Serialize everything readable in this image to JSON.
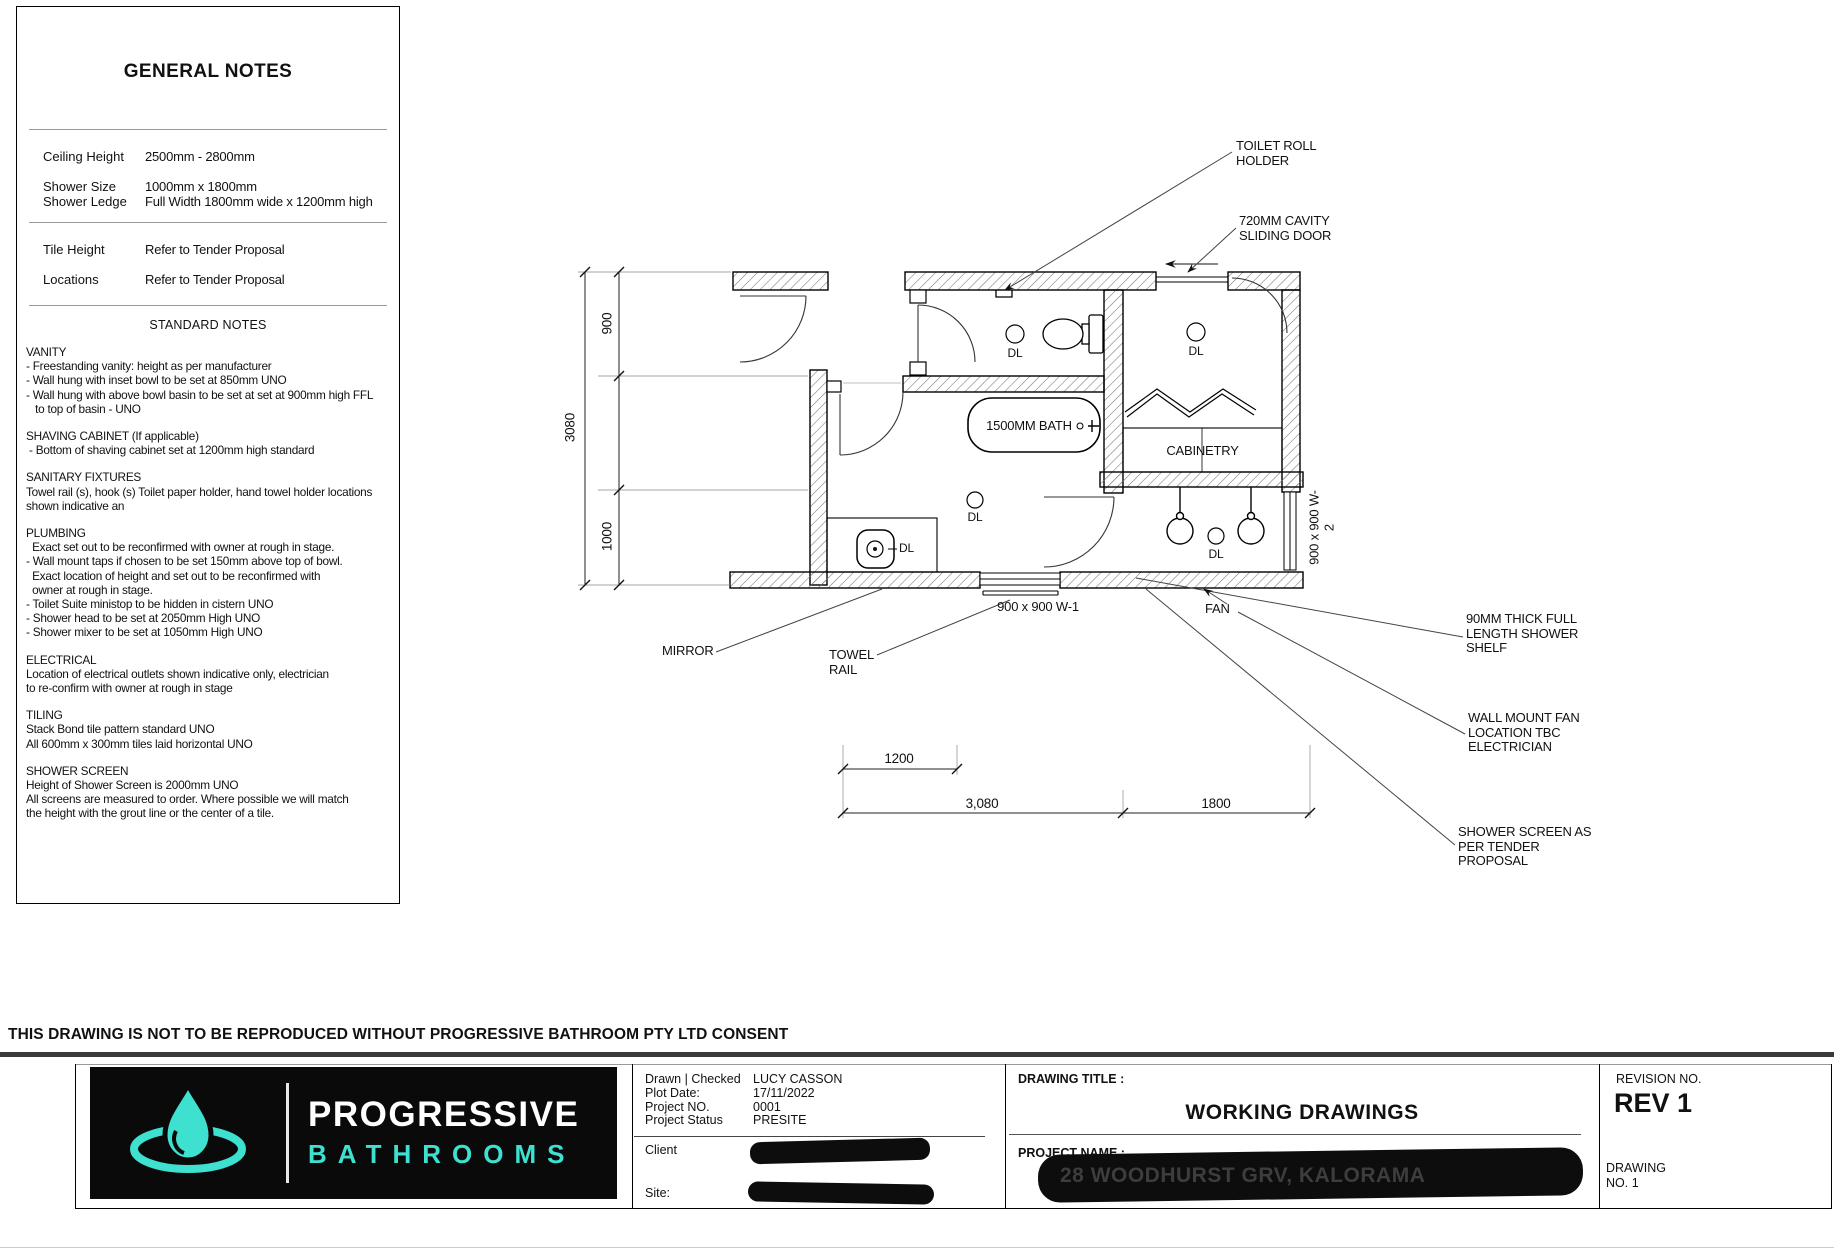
{
  "notes_panel": {
    "title": "GENERAL NOTES",
    "specs_a": [
      {
        "labels": [
          "Ceiling Height"
        ],
        "values": [
          "2500mm - 2800mm"
        ]
      },
      {
        "labels": [
          "Shower Size",
          "Shower Ledge"
        ],
        "values": [
          "1000mm x 1800mm",
          "Full Width 1800mm wide x 1200mm high"
        ]
      }
    ],
    "specs_b": [
      {
        "labels": [
          "Tile Height"
        ],
        "values": [
          "Refer to Tender Proposal"
        ]
      },
      {
        "labels": [
          "Locations"
        ],
        "values": [
          "Refer to Tender Proposal"
        ]
      }
    ],
    "standard_notes_title": "STANDARD NOTES",
    "sections": [
      {
        "heading": "VANITY",
        "lines": [
          "- Freestanding vanity: height as per manufacturer",
          "- Wall hung with inset bowl to be set at 850mm UNO",
          "- Wall hung with above bowl basin to be set at set at 900mm high FFL",
          "   to top of basin - UNO"
        ]
      },
      {
        "heading": "SHAVING CABINET (If applicable)",
        "lines": [
          " - Bottom of shaving cabinet set at 1200mm high standard"
        ]
      },
      {
        "heading": "SANITARY FIXTURES",
        "lines": [
          "Towel rail (s), hook (s) Toilet paper holder, hand towel holder locations",
          "shown indicative an"
        ]
      },
      {
        "heading": "PLUMBING",
        "lines": [
          "  Exact set out to be reconfirmed with owner at rough in stage.",
          "- Wall mount taps if chosen to be set 150mm above top of bowl.",
          "  Exact location of height and set out to be reconfirmed with",
          "  owner at rough in stage.",
          "- Toilet Suite ministop to be hidden in cistern UNO",
          "- Shower head to be set at 2050mm High UNO",
          "- Shower mixer to be set at 1050mm High UNO"
        ]
      },
      {
        "heading": "ELECTRICAL",
        "lines": [
          "Location of electrical outlets shown indicative only, electrician",
          "to re-confirm with owner at rough in stage"
        ]
      },
      {
        "heading": "TILING",
        "lines": [
          "Stack Bond tile pattern standard UNO",
          "All 600mm x 300mm tiles laid horizontal UNO"
        ]
      },
      {
        "heading": "SHOWER SCREEN",
        "lines": [
          "Height of Shower Screen is 2000mm UNO",
          "All screens are measured to order. Where possible we will match",
          "the height with the grout line or the center of a tile."
        ]
      }
    ]
  },
  "plan": {
    "labels": {
      "toilet_roll_holder": "TOILET ROLL HOLDER",
      "sliding_door": "720MM CAVITY SLIDING DOOR",
      "mirror": "MIRROR",
      "towel_rail": "TOWEL RAIL",
      "shower_shelf": "90MM THICK FULL LENGTH SHOWER SHELF",
      "wall_fan": "WALL MOUNT FAN LOCATION TBC ELECTRICIAN",
      "shower_screen": "SHOWER SCREEN AS PER TENDER PROPOSAL",
      "bath": "1500MM BATH",
      "cabinetry": "CABINETRY",
      "fan": "FAN",
      "window_w1": "900 x 900 W-1",
      "window_w2": "900 x 900 W-2",
      "downlight": "DL"
    },
    "dimensions": {
      "left_900": "900",
      "left_3080": "3080",
      "left_1000": "1000",
      "bottom_1200": "1200",
      "bottom_3080": "3,080",
      "bottom_1800": "1800"
    }
  },
  "footer": {
    "disclaimer": "THIS DRAWING IS NOT TO BE REPRODUCED WITHOUT PROGRESSIVE BATHROOM PTY LTD CONSENT",
    "logo": {
      "line1": "PROGRESSIVE",
      "line2": "BATHROOMS",
      "accent": "#3ee0d0"
    },
    "meta": [
      {
        "label": "Drawn | Checked",
        "value": "LUCY CASSON"
      },
      {
        "label": "Plot Date:",
        "value": "17/11/2022"
      },
      {
        "label": "Project NO.",
        "value": "0001"
      },
      {
        "label": "Project Status",
        "value": "PRESITE"
      }
    ],
    "client_label": "Client",
    "site_label": "Site:",
    "drawing_title_label": "DRAWING TITLE :",
    "drawing_title": "WORKING DRAWINGS",
    "project_name_label": "PROJECT NAME :",
    "project_name": "28 WOODHURST GRV, KALORAMA",
    "revision_label": "REVISION NO.",
    "revision": "REV 1",
    "drawing_no_label": "DRAWING",
    "drawing_no": "NO. 1"
  }
}
